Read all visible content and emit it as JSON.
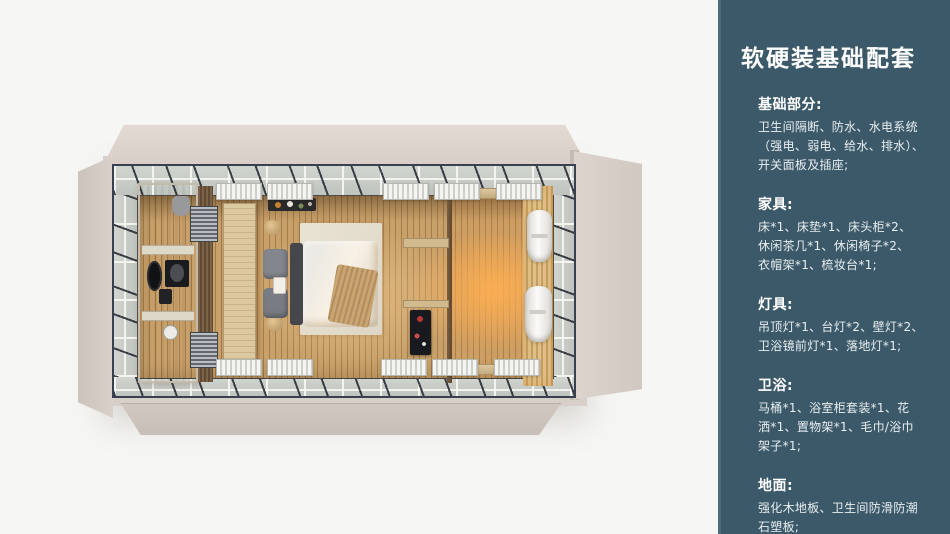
{
  "sidebar": {
    "bg_color": "#3c5969",
    "accent_edge_color": "#4e6a7a",
    "text_color": "#ffffff",
    "title": "软硬装基础配套",
    "sections": [
      {
        "heading": "基础部分:",
        "body": "卫生间隔断、防水、水电系统\n（强电、弱电、给水、排水）、\n开关面板及插座;"
      },
      {
        "heading": "家具:",
        "body": "床*1、床垫*1、床头柜*2、\n休闲茶几*1、休闲椅子*2、\n衣帽架*1、梳妆台*1;"
      },
      {
        "heading": "灯具:",
        "body": "吊顶灯*1、台灯*2、壁灯*2、\n卫浴镜前灯*1、落地灯*1;"
      },
      {
        "heading": "卫浴:",
        "body": "马桶*1、浴室柜套装*1、花\n洒*1、置物架*1、毛巾/浴巾\n架子*1;"
      },
      {
        "heading": "地面:",
        "body": "强化木地板、卫生间防滑防潮\n石塑板;"
      }
    ]
  },
  "render": {
    "type": "top-down-3d-cabin-room-render",
    "palette": {
      "background": "#f6f6f4",
      "shell_beige": "#d8d0c8",
      "frame_dark": "#39404f",
      "glass_band": "#c7cbc5",
      "floor_wood": "#bd9258",
      "warm_glow": "#ffb25c",
      "bathroom_stone": "#d6cfc0",
      "bed_white": "#f0ebe2",
      "curtain_white": "#f6f5f3"
    }
  }
}
